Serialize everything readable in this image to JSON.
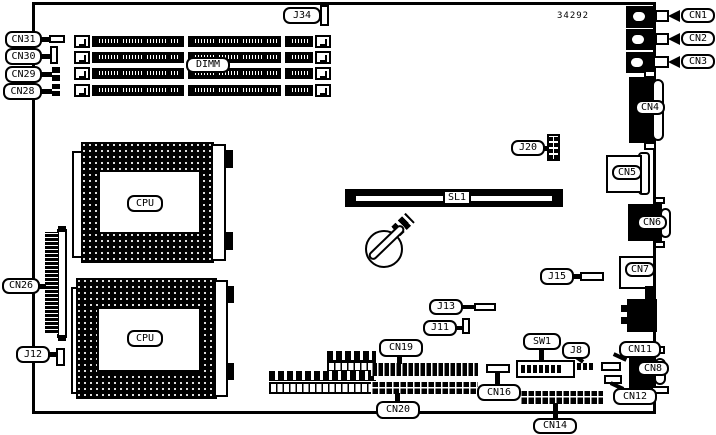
{
  "colors": {
    "ink": "#000000",
    "paper": "#ffffff"
  },
  "part_number": "34292",
  "callouts": {
    "cn31": "CN31",
    "cn30": "CN30",
    "cn29": "CN29",
    "cn28": "CN28",
    "j34": "J34",
    "dimm": "DIMM",
    "cn1": "CN1",
    "cn2": "CN2",
    "cn3": "CN3",
    "cn4": "CN4",
    "cn5": "CN5",
    "cn6": "CN6",
    "cn7": "CN7",
    "cn8": "CN8",
    "cn11": "CN11",
    "cn12": "CN12",
    "cn14": "CN14",
    "cn16": "CN16",
    "cn19": "CN19",
    "cn20": "CN20",
    "cn26": "CN26",
    "j8": "J8",
    "j11": "J11",
    "j12": "J12",
    "j13": "J13",
    "j15": "J15",
    "j20": "J20",
    "sw1": "SW1",
    "sl1": "SL1",
    "cpu1": "CPU",
    "cpu2": "CPU"
  }
}
